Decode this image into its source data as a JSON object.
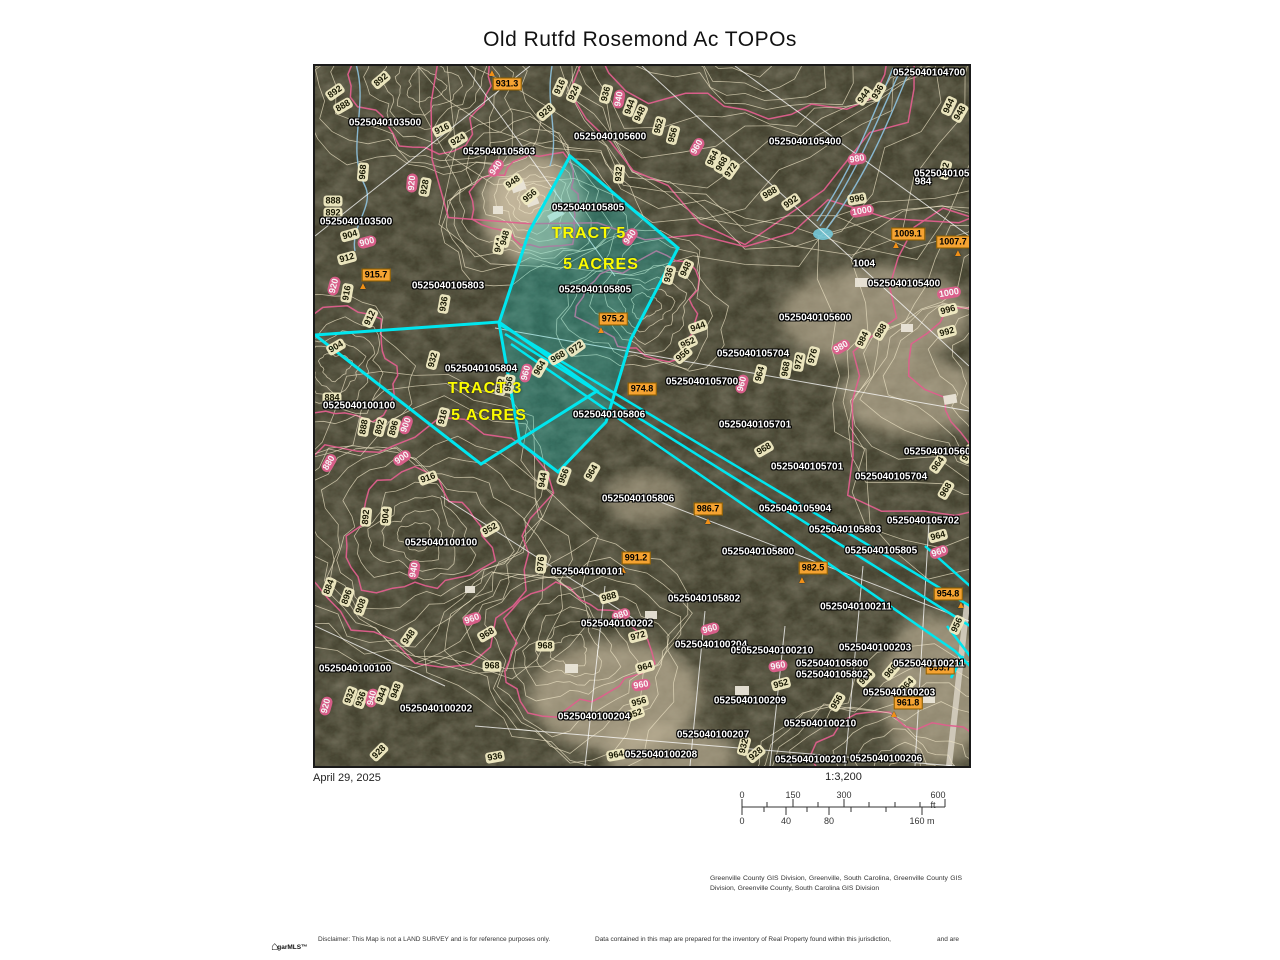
{
  "title": "Old Rutfd Rosemond Ac TOPOs",
  "footer": {
    "date": "April 29, 2025",
    "scale_ratio": "1:3,200"
  },
  "scale_bar": {
    "ft": [
      {
        "t": "0",
        "x": 0
      },
      {
        "t": "150",
        "x": 51
      },
      {
        "t": "300",
        "x": 102
      },
      {
        "t": "600 ft",
        "x": 196
      }
    ],
    "m": [
      {
        "t": "0",
        "x": 0
      },
      {
        "t": "40",
        "x": 44
      },
      {
        "t": "80",
        "x": 87
      },
      {
        "t": "160 m",
        "x": 180
      }
    ]
  },
  "attribution": "Greenville County GIS Division, Greenville, South Carolina, Greenville County GIS Division, Greenville County, South Carolina GIS Division",
  "disclaimer": [
    "Disclaimer: This Map is not a LAND SURVEY and is for reference purposes only.",
    "Data contained in this map are prepared for the inventory of Real Property found within this jurisdiction,",
    "and are"
  ],
  "logo_text": "garMLS™",
  "map": {
    "colors": {
      "cyan": "#00e6ef",
      "pink": "#df5f8d",
      "cream": "#f2ecc4",
      "orange": "#f5a332",
      "yellow": "#fcfc00"
    },
    "tracts": [
      {
        "label": "TRACT 5",
        "x": 274,
        "y": 168
      },
      {
        "label": "5 ACRES",
        "x": 286,
        "y": 199
      },
      {
        "label": "TRACT 3",
        "x": 170,
        "y": 323
      },
      {
        "label": "5 ACRES",
        "x": 174,
        "y": 350
      }
    ],
    "parcels": [
      [
        "0525040104700",
        614,
        7
      ],
      [
        "0525040103500",
        70,
        57
      ],
      [
        "0525040105600",
        295,
        71
      ],
      [
        "0525040105803",
        184,
        86
      ],
      [
        "0525040105400",
        490,
        76
      ],
      [
        "0525040105404",
        635,
        108
      ],
      [
        "984",
        608,
        116
      ],
      [
        "0525040103500",
        41,
        156
      ],
      [
        "0525040105805",
        273,
        142
      ],
      [
        "0525040105805",
        280,
        224
      ],
      [
        "0525040105400",
        589,
        218
      ],
      [
        "1004",
        549,
        198
      ],
      [
        "0525040105600",
        500,
        252
      ],
      [
        "0525040105704",
        438,
        288
      ],
      [
        "0525040105700",
        387,
        316
      ],
      [
        "0525040105803",
        133,
        220
      ],
      [
        "0525040105804",
        166,
        303
      ],
      [
        "0525040100100",
        44,
        340
      ],
      [
        "0525040105806",
        294,
        349
      ],
      [
        "0525040105701",
        440,
        359
      ],
      [
        "0525040105701",
        492,
        401
      ],
      [
        "0525040105600",
        625,
        386
      ],
      [
        "0525040105704",
        576,
        411
      ],
      [
        "0525040100100",
        126,
        477
      ],
      [
        "0525040105806",
        323,
        433
      ],
      [
        "0525040105904",
        480,
        443
      ],
      [
        "0525040105702",
        608,
        455
      ],
      [
        "0525040105803",
        530,
        464
      ],
      [
        "0525040105800",
        443,
        486
      ],
      [
        "0525040105805",
        566,
        485
      ],
      [
        "0525040100101",
        272,
        506
      ],
      [
        "0525040105802",
        389,
        533
      ],
      [
        "0525040100211",
        541,
        541
      ],
      [
        "0525040100202",
        302,
        558
      ],
      [
        "0525040100204",
        396,
        579
      ],
      [
        "052",
        424,
        585
      ],
      [
        "0525040100210",
        462,
        585
      ],
      [
        "0525040100203",
        560,
        582
      ],
      [
        "0525040105800",
        517,
        598
      ],
      [
        "0525040100211",
        614,
        598
      ],
      [
        "0525040105802",
        517,
        609
      ],
      [
        "0525040100100",
        40,
        603
      ],
      [
        "0525040100203",
        584,
        627
      ],
      [
        "0525040100209",
        435,
        635
      ],
      [
        "0525040100202",
        121,
        643
      ],
      [
        "0525040100204",
        279,
        651
      ],
      [
        "0525040100210",
        505,
        658
      ],
      [
        "0525040100207",
        398,
        669
      ],
      [
        "0525040100208",
        346,
        689
      ],
      [
        "0525040100201",
        496,
        694
      ],
      [
        "0525040100206",
        571,
        693
      ]
    ],
    "contours": [
      [
        "892",
        66,
        14,
        -40,
        0
      ],
      [
        "892",
        20,
        26,
        -35,
        0
      ],
      [
        "888",
        28,
        40,
        -30,
        0
      ],
      [
        "916",
        127,
        63,
        -25,
        0
      ],
      [
        "924",
        143,
        74,
        -30,
        0
      ],
      [
        "940",
        181,
        102,
        -55,
        1
      ],
      [
        "948",
        198,
        116,
        -35,
        0
      ],
      [
        "928",
        110,
        121,
        -80,
        0
      ],
      [
        "920",
        97,
        117,
        -85,
        1
      ],
      [
        "968",
        48,
        106,
        -85,
        0
      ],
      [
        "888",
        18,
        135,
        0,
        0
      ],
      [
        "892",
        18,
        147,
        0,
        0
      ],
      [
        "904",
        35,
        169,
        -15,
        0
      ],
      [
        "900",
        52,
        176,
        -15,
        1
      ],
      [
        "956",
        215,
        130,
        -40,
        0
      ],
      [
        "916",
        245,
        21,
        -65,
        0
      ],
      [
        "924",
        259,
        27,
        -65,
        0
      ],
      [
        "928",
        231,
        46,
        -40,
        0
      ],
      [
        "936",
        291,
        28,
        -75,
        0
      ],
      [
        "940",
        304,
        33,
        -80,
        1
      ],
      [
        "944",
        315,
        41,
        -70,
        0
      ],
      [
        "948",
        325,
        48,
        -65,
        0
      ],
      [
        "952",
        344,
        60,
        -75,
        0
      ],
      [
        "956",
        358,
        69,
        -75,
        0
      ],
      [
        "960",
        382,
        81,
        -60,
        1
      ],
      [
        "964",
        398,
        92,
        -65,
        0
      ],
      [
        "968",
        407,
        98,
        -60,
        0
      ],
      [
        "972",
        416,
        104,
        -55,
        0
      ],
      [
        "932",
        304,
        108,
        -85,
        0
      ],
      [
        "936",
        563,
        26,
        -60,
        0
      ],
      [
        "944",
        549,
        30,
        -55,
        0
      ],
      [
        "944",
        634,
        40,
        -65,
        0
      ],
      [
        "948",
        645,
        47,
        -60,
        0
      ],
      [
        "932",
        630,
        104,
        -75,
        0
      ],
      [
        "980",
        542,
        93,
        -10,
        1
      ],
      [
        "988",
        455,
        127,
        -30,
        0
      ],
      [
        "992",
        476,
        136,
        -35,
        0
      ],
      [
        "996",
        542,
        133,
        -10,
        0
      ],
      [
        "1000",
        547,
        145,
        -10,
        1
      ],
      [
        "940",
        315,
        171,
        -55,
        1
      ],
      [
        "936",
        354,
        209,
        -75,
        0
      ],
      [
        "948",
        371,
        203,
        -65,
        0
      ],
      [
        "944",
        383,
        261,
        -20,
        0
      ],
      [
        "952",
        373,
        277,
        -25,
        0
      ],
      [
        "956",
        368,
        289,
        -40,
        0
      ],
      [
        "944",
        184,
        179,
        -80,
        0
      ],
      [
        "948",
        190,
        172,
        -75,
        0
      ],
      [
        "912",
        32,
        192,
        -15,
        0
      ],
      [
        "920",
        19,
        220,
        -75,
        1
      ],
      [
        "916",
        32,
        227,
        -80,
        0
      ],
      [
        "912",
        55,
        252,
        -65,
        0
      ],
      [
        "936",
        129,
        238,
        -80,
        0
      ],
      [
        "904",
        21,
        281,
        -30,
        0
      ],
      [
        "932",
        118,
        294,
        -75,
        0
      ],
      [
        "960",
        211,
        307,
        -75,
        1
      ],
      [
        "964",
        225,
        302,
        -60,
        0
      ],
      [
        "968",
        243,
        291,
        -30,
        0
      ],
      [
        "972",
        261,
        282,
        -35,
        0
      ],
      [
        "952",
        186,
        320,
        -80,
        0
      ],
      [
        "956",
        194,
        318,
        -80,
        0
      ],
      [
        "884",
        17,
        332,
        0,
        0
      ],
      [
        "888",
        49,
        361,
        -80,
        0
      ],
      [
        "892",
        65,
        361,
        -75,
        0
      ],
      [
        "896",
        79,
        362,
        -75,
        0
      ],
      [
        "900",
        91,
        359,
        -70,
        1
      ],
      [
        "916",
        128,
        351,
        -75,
        0
      ],
      [
        "880",
        14,
        397,
        -60,
        1
      ],
      [
        "900",
        87,
        392,
        -35,
        1
      ],
      [
        "916",
        113,
        412,
        -20,
        0
      ],
      [
        "944",
        228,
        414,
        -80,
        0
      ],
      [
        "956",
        249,
        410,
        -70,
        0
      ],
      [
        "964",
        277,
        406,
        -60,
        0
      ],
      [
        "892",
        51,
        451,
        -85,
        0
      ],
      [
        "904",
        71,
        450,
        -85,
        0
      ],
      [
        "952",
        175,
        463,
        -30,
        0
      ],
      [
        "940",
        99,
        504,
        -80,
        1
      ],
      [
        "884",
        14,
        521,
        -70,
        0
      ],
      [
        "896",
        32,
        531,
        -70,
        0
      ],
      [
        "908",
        46,
        540,
        -70,
        0
      ],
      [
        "976",
        226,
        498,
        -85,
        0
      ],
      [
        "988",
        294,
        531,
        -15,
        0
      ],
      [
        "980",
        306,
        549,
        -20,
        1
      ],
      [
        "960",
        157,
        553,
        -20,
        1
      ],
      [
        "948",
        94,
        571,
        -55,
        0
      ],
      [
        "968",
        172,
        568,
        -30,
        0
      ],
      [
        "968",
        230,
        580,
        0,
        0
      ],
      [
        "968",
        177,
        600,
        0,
        0
      ],
      [
        "972",
        323,
        570,
        -15,
        0
      ],
      [
        "964",
        330,
        601,
        -15,
        0
      ],
      [
        "960",
        326,
        619,
        -10,
        1
      ],
      [
        "956",
        324,
        636,
        -15,
        0
      ],
      [
        "952",
        320,
        648,
        -20,
        0
      ],
      [
        "920",
        11,
        640,
        -75,
        1
      ],
      [
        "932",
        35,
        630,
        -70,
        0
      ],
      [
        "936",
        46,
        633,
        -70,
        0
      ],
      [
        "940",
        57,
        632,
        -75,
        1
      ],
      [
        "944",
        67,
        629,
        -70,
        0
      ],
      [
        "948",
        81,
        625,
        -70,
        0
      ],
      [
        "928",
        64,
        686,
        -45,
        0
      ],
      [
        "936",
        180,
        691,
        -10,
        0
      ],
      [
        "964",
        301,
        689,
        -10,
        0
      ],
      [
        "932",
        429,
        680,
        -75,
        0
      ],
      [
        "928",
        441,
        688,
        -40,
        0
      ],
      [
        "956",
        522,
        636,
        -60,
        0
      ],
      [
        "952",
        466,
        618,
        -15,
        0
      ],
      [
        "960",
        463,
        600,
        -10,
        1
      ],
      [
        "960",
        395,
        563,
        -15,
        1
      ],
      [
        "964",
        551,
        612,
        -45,
        0
      ],
      [
        "964",
        592,
        619,
        -45,
        0
      ],
      [
        "960",
        576,
        605,
        -50,
        0
      ],
      [
        "956",
        642,
        559,
        -65,
        0
      ],
      [
        "960",
        624,
        486,
        -20,
        1
      ],
      [
        "964",
        623,
        470,
        -15,
        0
      ],
      [
        "968",
        631,
        424,
        -60,
        0
      ],
      [
        "972",
        653,
        388,
        -60,
        0
      ],
      [
        "964",
        623,
        398,
        -55,
        0
      ],
      [
        "968",
        449,
        383,
        -30,
        0
      ],
      [
        "1000",
        634,
        227,
        -10,
        1
      ],
      [
        "996",
        633,
        244,
        -15,
        0
      ],
      [
        "992",
        632,
        266,
        -15,
        0
      ],
      [
        "988",
        566,
        265,
        -60,
        0
      ],
      [
        "984",
        548,
        273,
        -65,
        0
      ],
      [
        "980",
        526,
        281,
        -30,
        1
      ],
      [
        "976",
        498,
        290,
        -75,
        0
      ],
      [
        "972",
        484,
        296,
        -80,
        0
      ],
      [
        "968",
        471,
        303,
        -80,
        0
      ],
      [
        "964",
        445,
        308,
        -75,
        0
      ],
      [
        "960",
        427,
        318,
        -75,
        1
      ]
    ],
    "spots": [
      [
        "931.3",
        192,
        18,
        177,
        8
      ],
      [
        "1009.1",
        593,
        168,
        581,
        180
      ],
      [
        "1007.7",
        638,
        176,
        643,
        188
      ],
      [
        "915.7",
        61,
        209,
        48,
        221
      ],
      [
        "975.2",
        298,
        253,
        286,
        265
      ],
      [
        "974.8",
        327,
        323,
        null,
        null
      ],
      [
        "986.7",
        393,
        443,
        393,
        456
      ],
      [
        "991.2",
        321,
        492,
        308,
        505
      ],
      [
        "982.5",
        498,
        502,
        487,
        515
      ],
      [
        "954.8",
        633,
        528,
        646,
        540
      ],
      [
        "955.7",
        625,
        602,
        null,
        null
      ],
      [
        "961.8",
        593,
        637,
        579,
        649
      ]
    ]
  }
}
